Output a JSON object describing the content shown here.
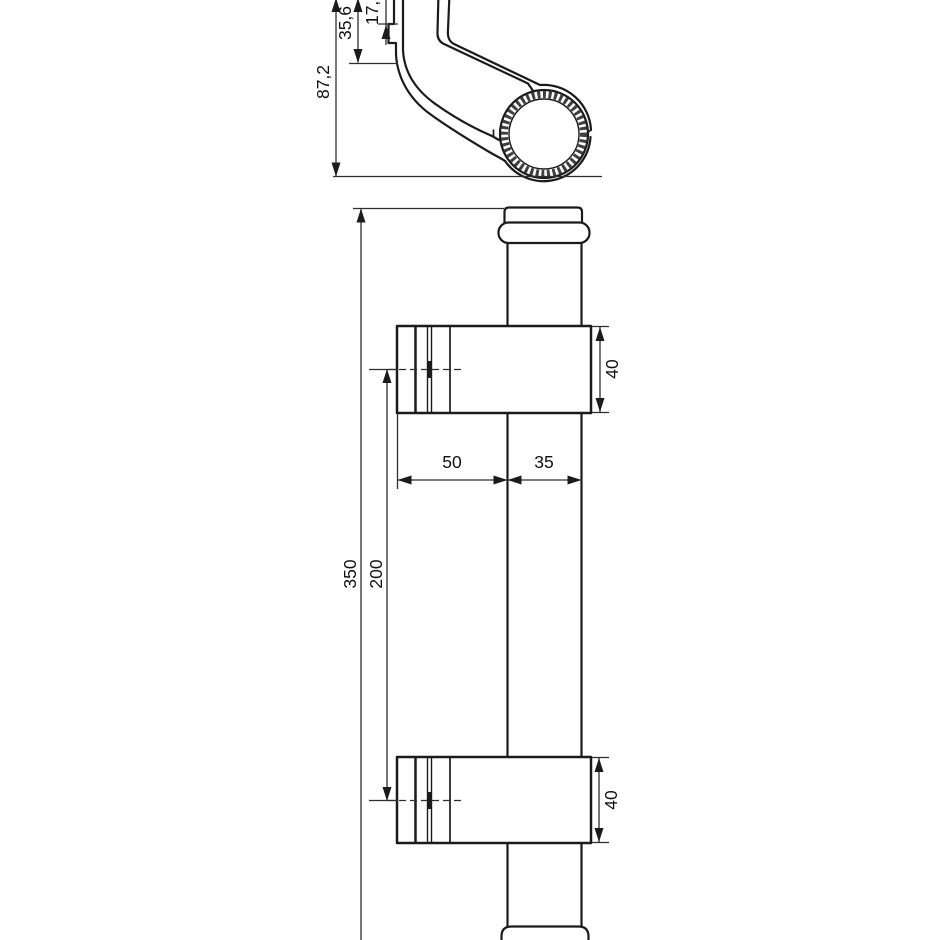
{
  "drawing": {
    "background": "#ffffff",
    "line_color": "#1b1b1b",
    "dim_line_color": "#2e2e2e",
    "knurl_color": "#3f3f3f",
    "section_view": {
      "dim_height_overall": "87,2",
      "dim_height_mid": "35,6",
      "dim_height_top": "17,3"
    },
    "front_view": {
      "dim_length_overall": "350",
      "dim_bracket_centers": "200",
      "dim_bracket_depth": "50",
      "dim_tube_width": "35",
      "dim_upper_bracket": "40",
      "dim_lower_bracket": "40"
    }
  }
}
